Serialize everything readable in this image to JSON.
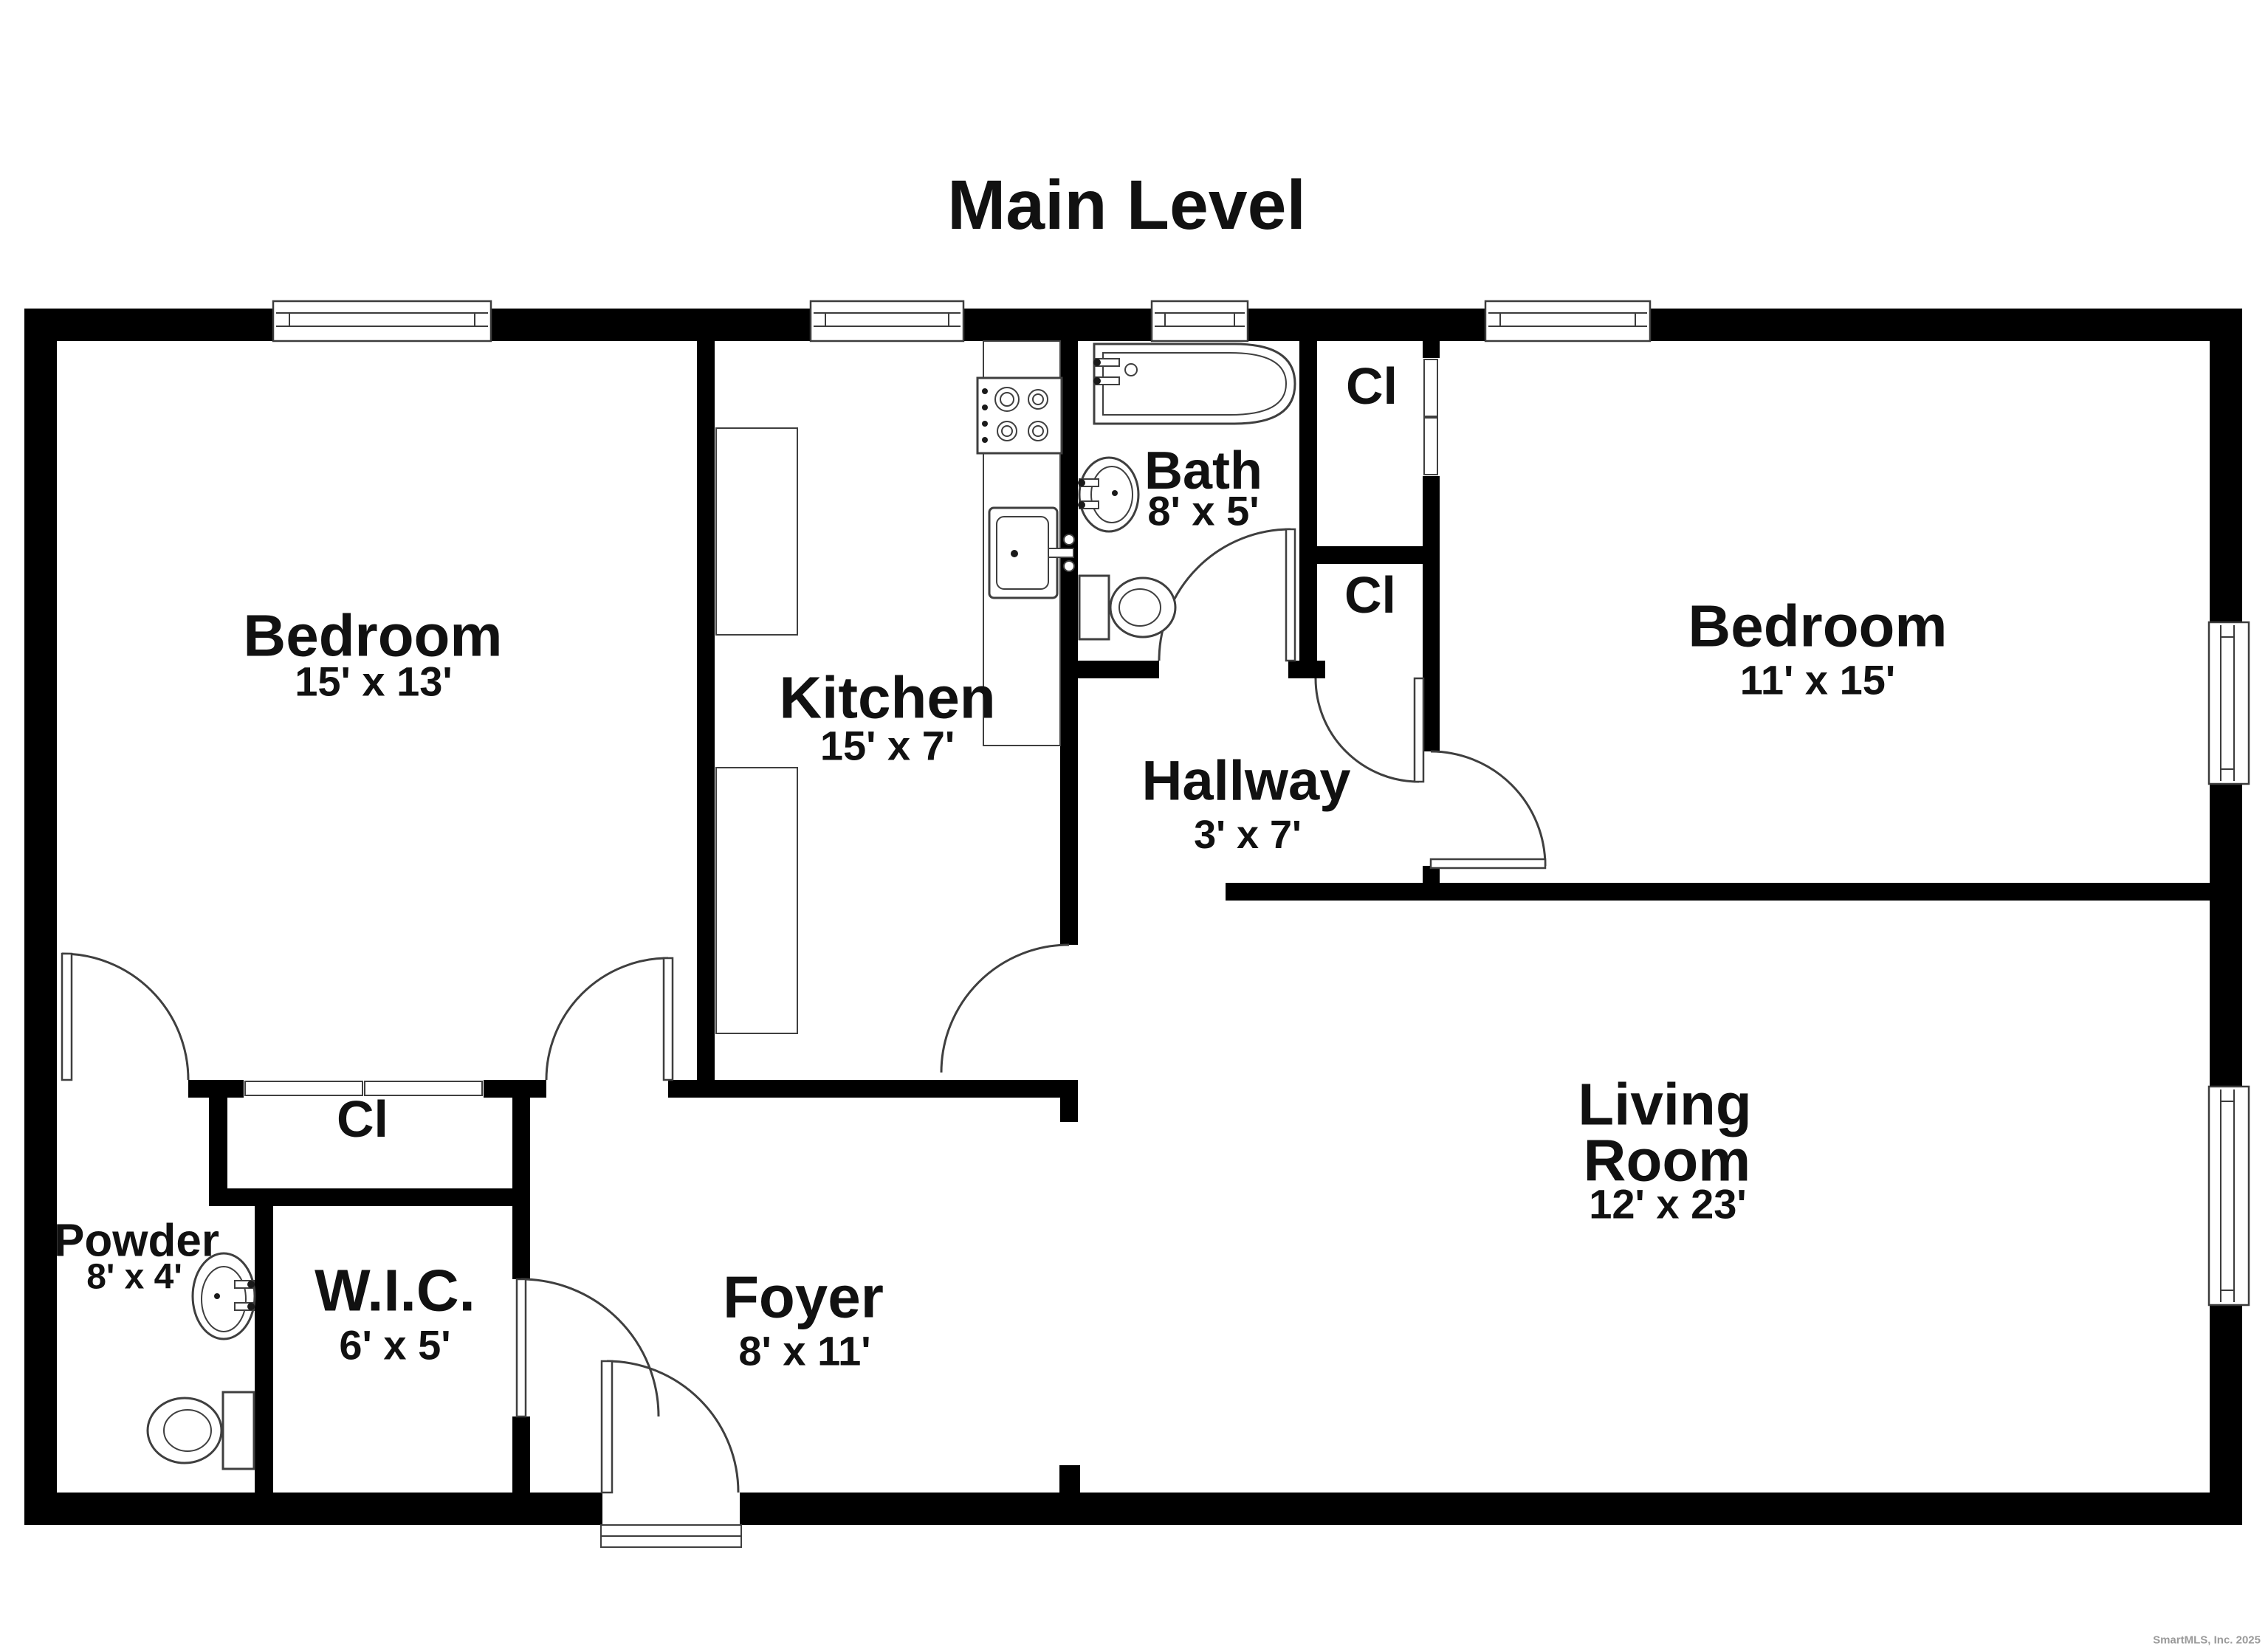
{
  "page": {
    "title": "Main Level",
    "watermark": "SmartMLS, Inc. 2025",
    "background": "#ffffff"
  },
  "colors": {
    "walls": "#000000",
    "fixtures_stroke": "#3f3f3f",
    "text": "#111111",
    "watermark": "#9a9a9a"
  },
  "rooms": [
    {
      "id": "bedroom-left",
      "name": "Bedroom",
      "dims": "15' x 13'"
    },
    {
      "id": "kitchen",
      "name": "Kitchen",
      "dims": "15' x 7'"
    },
    {
      "id": "bath",
      "name": "Bath",
      "dims": "8' x 5'"
    },
    {
      "id": "bedroom-right",
      "name": "Bedroom",
      "dims": "11' x 15'"
    },
    {
      "id": "hallway",
      "name": "Hallway",
      "dims": "3' x 7'"
    },
    {
      "id": "living-room",
      "name": "Living Room",
      "name_lines": [
        "Living",
        "Room"
      ],
      "dims": "12' x 23'"
    },
    {
      "id": "foyer",
      "name": "Foyer",
      "dims": "8' x 11'"
    },
    {
      "id": "wic",
      "name": "W.I.C.",
      "dims": "6' x 5'"
    },
    {
      "id": "powder",
      "name": "Powder",
      "dims": "8' x 4'"
    }
  ],
  "closets": [
    {
      "id": "closet-top",
      "label": "Cl"
    },
    {
      "id": "closet-mid",
      "label": "Cl"
    },
    {
      "id": "closet-bedroom-left",
      "label": "Cl"
    }
  ],
  "fixtures": [
    "bathtub",
    "bathroom-sink",
    "toilet",
    "kitchen-stove",
    "kitchen-sink",
    "kitchen-counter",
    "powder-sink",
    "powder-toilet"
  ]
}
